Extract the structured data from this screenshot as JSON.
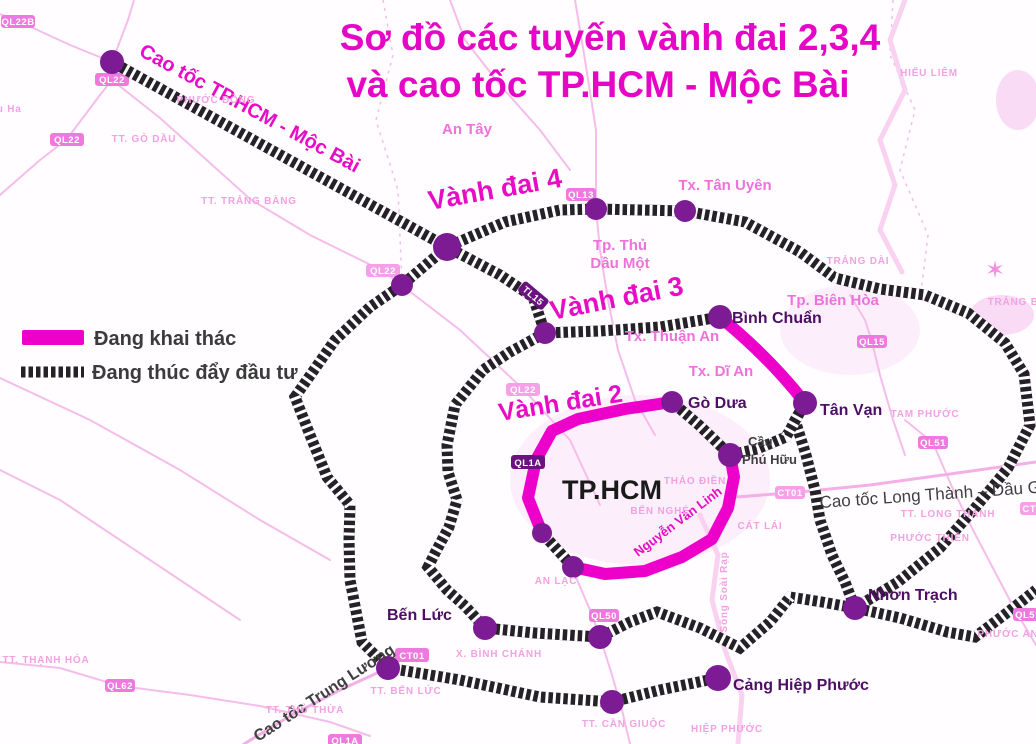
{
  "title": {
    "line1": "Sơ đồ các tuyến vành đai 2,3,4",
    "line2": "và cao tốc TP.HCM - Mộc Bài"
  },
  "legend": {
    "operating": "Đang khai thác",
    "investing": "Đang thúc đẩy đầu tư"
  },
  "routes": {
    "moc_bai": "Cao tốc TP.HCM - Mộc Bài",
    "ring4": "Vành đai 4",
    "ring3": "Vành đai 3",
    "ring2": "Vành đai 2",
    "nguyen_van_linh": "Nguyễn Văn Linh",
    "trung_luong": "Cao tốc Trung Lương",
    "long_thanh": "Cao tốc Long Thành – Dầu Giây"
  },
  "junctions": {
    "binh_chuan": "Bình Chuẩn",
    "go_dua": "Gò Dưa",
    "tan_van": "Tân Vạn",
    "nhon_trach": "Nhơn Trạch",
    "ben_luc": "Bến Lức",
    "cang_hiep_phuoc": "Cảng Hiệp Phước",
    "cau_phu_huu_line1": "Cầu",
    "cau_phu_huu_line2": "Phú Hữu"
  },
  "city": {
    "tphcm": "TP.HCM",
    "tan_uyen": "Tx. Tân Uyên",
    "thu_dau_mot_line1": "Tp. Thủ",
    "thu_dau_mot_line2": "Dầu Một",
    "bien_hoa": "Tp. Biên Hòa",
    "thuan_an": "Tx. Thuận An",
    "di_an": "Tx. Dĩ An",
    "an_tay": "An Tây"
  },
  "areas": {
    "dau_ha": "Dầu Ha",
    "go_dau": "TT. GÒ DẦU",
    "trang_bang": "TT. TRẢNG BÀNG",
    "phuoc_dong": "PHƯỚC ĐÔNG",
    "hieu_liem": "HIẾU LIÊM",
    "trang_dai": "TRẢNG DÀI",
    "trang_bom": "TRẢNG BOM",
    "tam_phuoc": "TAM PHƯỚC",
    "thao_dien": "THẢO ĐIỀN",
    "ben_nghe": "BẾN NGHÉ",
    "cat_lai": "CÁT LÁI",
    "an_lac": "AN LẠC",
    "binh_chanh": "X. BÌNH CHÁNH",
    "tt_ben_luc": "TT. BẾN LỨC",
    "tt_can_giuoc": "TT. CẦN GIUỘC",
    "hiep_phuoc": "HIỆP PHƯỚC",
    "tt_long_thanh": "TT. LONG THÀNH",
    "phuoc_thien": "PHƯỚC THIỀN",
    "phuoc_an": "PHƯỚC AN",
    "thanh_hoa": "TT. THẠNH HÓA",
    "thu_thua": "TT. THỦ THỪA"
  },
  "river": {
    "soai_rap": "Sông Soài Rạp"
  },
  "badges": {
    "ql22b": "QL22B",
    "ql22_top": "QL22",
    "ql22_left": "QL22",
    "ql22_mid": "QL22",
    "ql22_inner": "QL22",
    "ql13": "QL13",
    "tl15": "TL15",
    "ql1a": "QL1A",
    "ql15": "QL15",
    "ql51": "QL51",
    "ql51_edge": "QL51",
    "ql50": "QL50",
    "ql62": "QL62",
    "ct01_west": "CT01",
    "ct01_east": "CT01",
    "ct01_edge": "CT01",
    "ql1a_bottom": "QL1A"
  },
  "colors": {
    "magenta_route": "#ee00cb",
    "title_magenta": "#e606c6",
    "node_purple": "#7c1b93",
    "junction_label": "#4c0f63",
    "city_pink": "#ee72da",
    "faint_pink": "#f2a2e2",
    "badge_pink": "#ef79df",
    "badge_dark": "#6b1280",
    "hatch_dark": "#262028"
  }
}
